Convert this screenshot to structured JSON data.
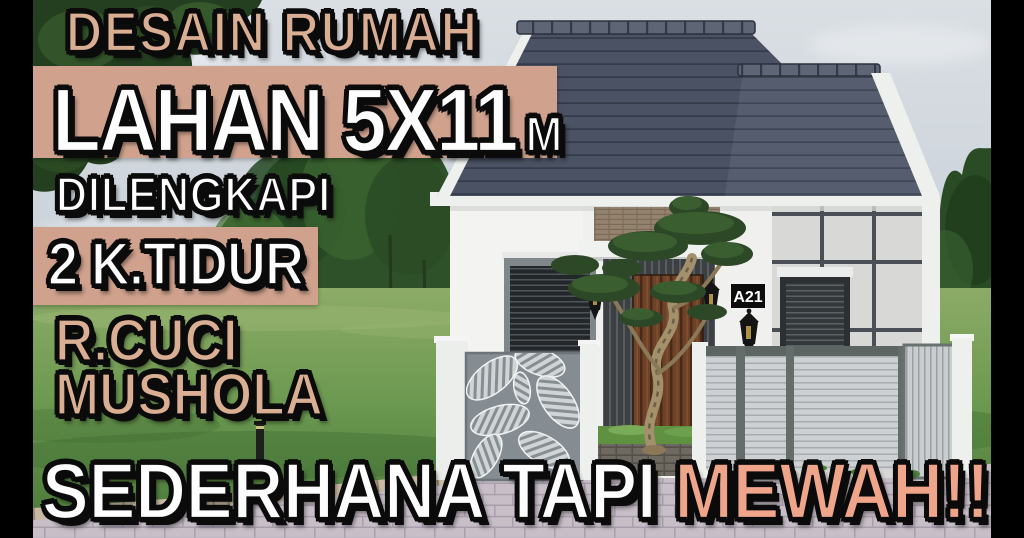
{
  "thumbnail": {
    "title_top": "DESAIN RUMAH",
    "land_size": "LAHAN 5X11",
    "land_unit": "M",
    "equipped_label": "DILENGKAPI",
    "feature_bedrooms": "2 K.TIDUR",
    "feature_laundry": "R.CUCI",
    "feature_prayer": "MUSHOLA",
    "tagline_white": "SEDERHANA TAPI",
    "tagline_accent": "MEWAH!!"
  },
  "house": {
    "number_plate": "A21"
  },
  "palette": {
    "band_tan": "#d0a28d",
    "letter_tan": "#d9ae93",
    "letter_salmon": "#efa58a",
    "letter_white": "#fdfdfd",
    "outline_black": "#0b0b0b",
    "roof_slate": "#4a5263",
    "wall_white": "#f3f4f2",
    "grid_wall_gray": "#d8d9d7",
    "fence_gray": "#ccd0d2",
    "grass_green": "#6f9a52",
    "sky_gray_blue": "#ccd4db",
    "paving_mauve": "#c6bdc6"
  }
}
